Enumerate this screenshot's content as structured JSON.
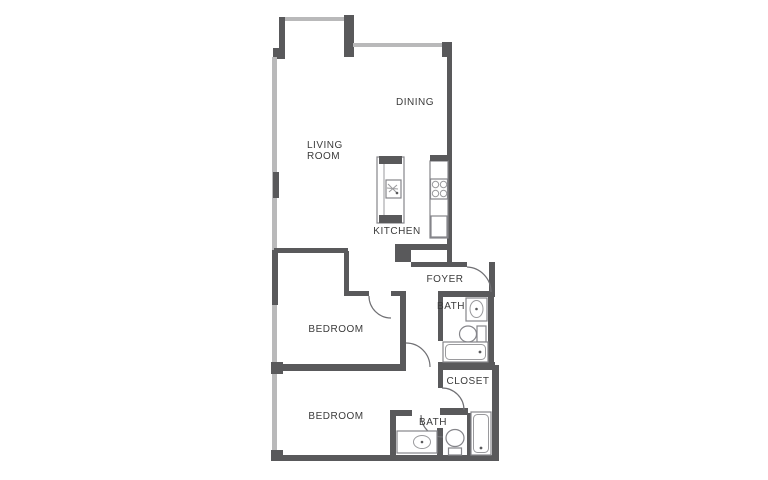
{
  "title": "Two-bedroom apartment floor plan",
  "colors": {
    "wall_dark": "#59595b",
    "wall_light": "#b9b9ba",
    "fixture_outline": "#85858a",
    "door_arc": "#707074",
    "label_text": "#3b3b3b",
    "background": "#ffffff"
  },
  "rooms": {
    "living_room": {
      "line1": "LIVING",
      "line2": "ROOM"
    },
    "dining": {
      "label": "DINING"
    },
    "kitchen": {
      "label": "KITCHEN"
    },
    "foyer": {
      "label": "FOYER"
    },
    "bath_upper": {
      "label": "BATH"
    },
    "bedroom_mid": {
      "label": "BEDROOM"
    },
    "closet": {
      "label": "CLOSET"
    },
    "bedroom_low": {
      "label": "BEDROOM"
    },
    "bath_lower": {
      "label": "BATH"
    }
  }
}
